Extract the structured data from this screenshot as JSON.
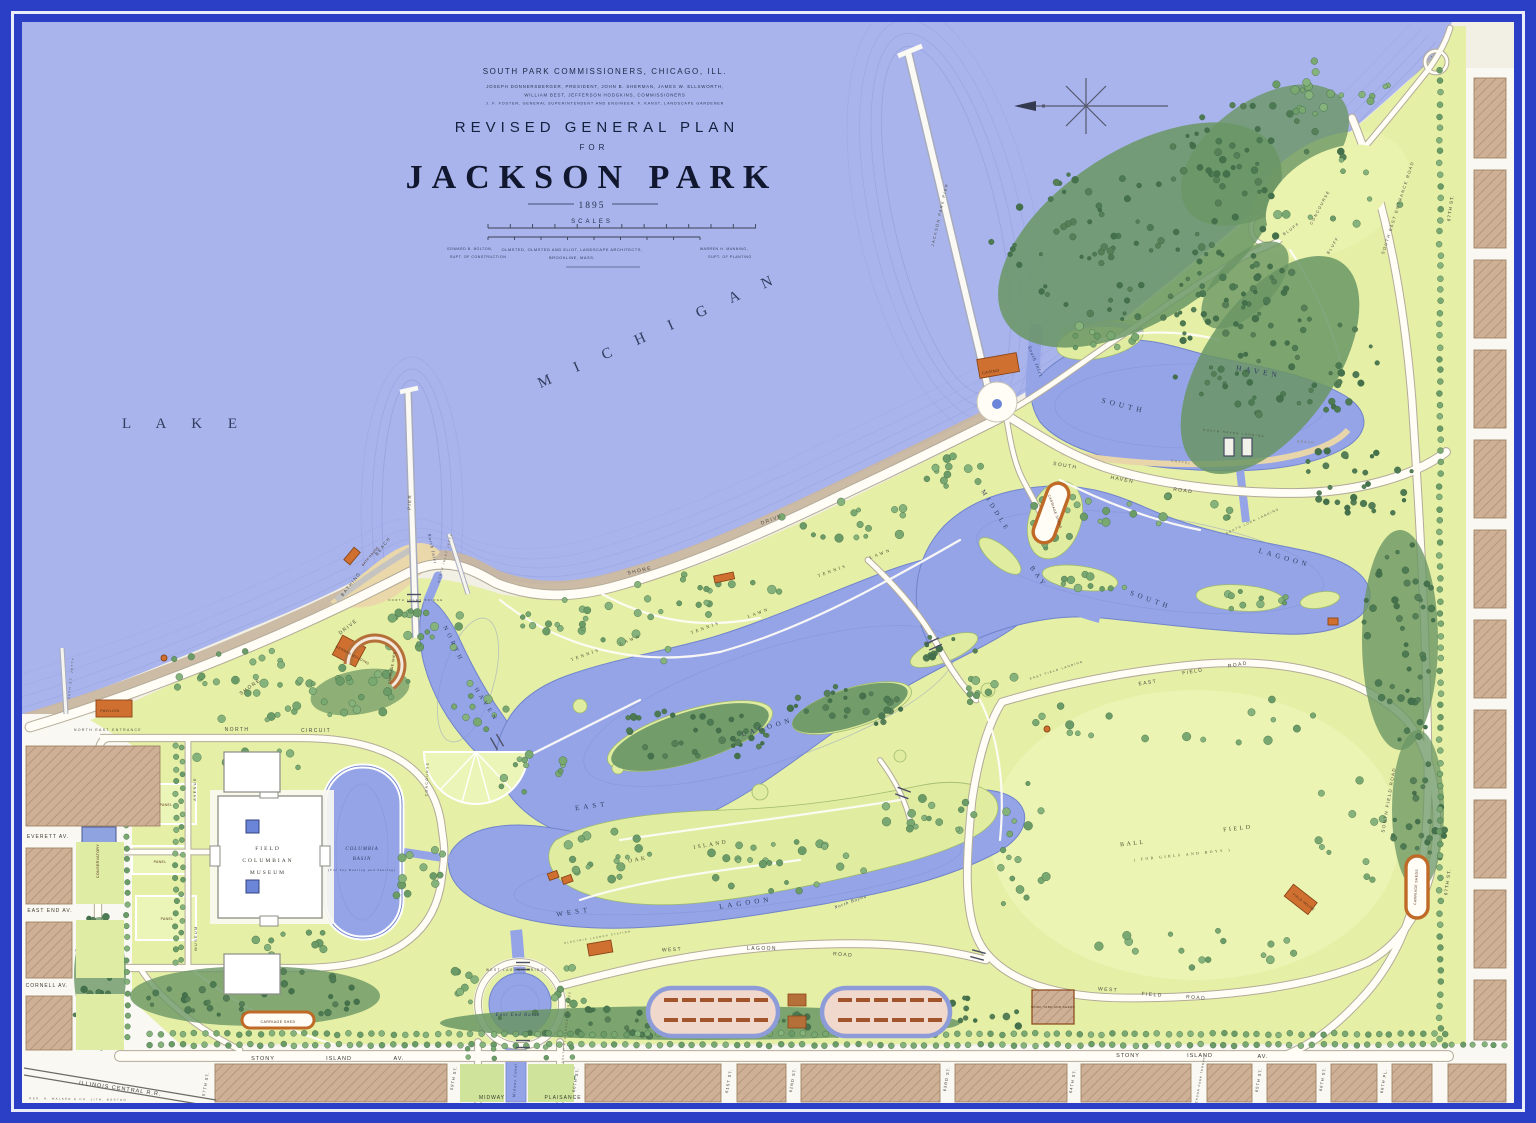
{
  "map": {
    "palette": {
      "frame_blue": "#2b3fc6",
      "frame_line": "#e9ecf9",
      "lake": "#a9b4ec",
      "lagoon": "#94a4e6",
      "park_green": "#e5efa5",
      "forest": "#6a9664",
      "city_block": "#cdb096",
      "gravel_shore": "#c9b7a1",
      "building_orange": "#cf7030",
      "road_white": "#fffdf6",
      "ink": "#27304f"
    },
    "title_block": {
      "org": "SOUTH PARK COMMISSIONERS, CHICAGO, ILL.",
      "line1": "JOSEPH DONNERSBERGER, PRESIDENT, JOHN B. SHERMAN, JAMES W. ELLSWORTH,",
      "line2": "WILLIAM BEST, JEFFERSON HODGKINS, COMMISSIONERS",
      "line3": "J. F. FOSTER, GENERAL SUPERINTENDENT AND ENGINEER, F. KANST, LANDSCAPE GARDENER",
      "title": "REVISED GENERAL PLAN",
      "for_word": "FOR",
      "park_name": "JACKSON PARK",
      "year": "1895",
      "scales": "SCALES",
      "credit_left1": "EDWARD B. BOLTON,",
      "credit_left2": "SUPT. OF CONSTRUCTION",
      "credit_center1": "OLMSTED, OLMSTED AND ELIOT, LANDSCAPE ARCHITECTS,",
      "credit_center2": "BROOKLINE,   MASS.",
      "credit_right1": "WARREN H. MANNING,",
      "credit_right2": "SUPT. OF PLANTING"
    },
    "labels": [
      {
        "t": "L A K E",
        "x": 185,
        "y": 428,
        "r": 0,
        "s": 15,
        "c": "big"
      },
      {
        "t": "M I C H I G A N",
        "x": 662,
        "y": 334,
        "r": -24,
        "s": 15,
        "c": "big"
      },
      {
        "t": "SOUTH",
        "x": 1123,
        "y": 408,
        "r": 14,
        "s": 7.5,
        "c": "wl"
      },
      {
        "t": "HAVEN",
        "x": 1258,
        "y": 374,
        "r": 10,
        "s": 7.5,
        "c": "wl"
      },
      {
        "t": "South Inlet",
        "x": 1034,
        "y": 362,
        "r": 68,
        "s": 5,
        "c": "wi"
      },
      {
        "t": "MIDDLE",
        "x": 994,
        "y": 512,
        "r": 58,
        "s": 6.5,
        "c": "wl"
      },
      {
        "t": "BAY",
        "x": 1037,
        "y": 578,
        "r": 55,
        "s": 6.5,
        "c": "wl"
      },
      {
        "t": "SOUTH",
        "x": 1150,
        "y": 602,
        "r": 20,
        "s": 7,
        "c": "wl"
      },
      {
        "t": "LAGOON",
        "x": 1284,
        "y": 560,
        "r": 16,
        "s": 7,
        "c": "wl"
      },
      {
        "t": "NORTH",
        "x": 452,
        "y": 645,
        "r": 64,
        "s": 6,
        "c": "wl"
      },
      {
        "t": "HAVEN",
        "x": 485,
        "y": 706,
        "r": 58,
        "s": 6,
        "c": "wl"
      },
      {
        "t": "North Inlet",
        "x": 431,
        "y": 549,
        "r": 78,
        "s": 4.5,
        "c": "wi"
      },
      {
        "t": "EAST",
        "x": 592,
        "y": 808,
        "r": -8,
        "s": 7,
        "c": "wl"
      },
      {
        "t": "LAGOON",
        "x": 768,
        "y": 729,
        "r": -16,
        "s": 7,
        "c": "wl"
      },
      {
        "t": "WEST",
        "x": 574,
        "y": 914,
        "r": -8,
        "s": 7,
        "c": "wl"
      },
      {
        "t": "LAGOON",
        "x": 746,
        "y": 905,
        "r": -8,
        "s": 7,
        "c": "wl"
      },
      {
        "t": "North Bayou",
        "x": 851,
        "y": 903,
        "r": -20,
        "s": 4.5,
        "c": "wi"
      },
      {
        "t": "OAK",
        "x": 638,
        "y": 861,
        "r": -10,
        "s": 5.5,
        "c": "al"
      },
      {
        "t": "ISLAND",
        "x": 711,
        "y": 846,
        "r": -10,
        "s": 5.5,
        "c": "al"
      },
      {
        "t": "TENNIS",
        "x": 586,
        "y": 656,
        "r": -20,
        "s": 4.5,
        "c": "al"
      },
      {
        "t": "LAWN",
        "x": 631,
        "y": 641,
        "r": -20,
        "s": 4.5,
        "c": "al"
      },
      {
        "t": "TENNIS",
        "x": 706,
        "y": 629,
        "r": -20,
        "s": 4.5,
        "c": "al"
      },
      {
        "t": "LAWN",
        "x": 759,
        "y": 614,
        "r": -20,
        "s": 4.5,
        "c": "al"
      },
      {
        "t": "TENNIS",
        "x": 833,
        "y": 572,
        "r": -20,
        "s": 4.5,
        "c": "al"
      },
      {
        "t": "LAWN",
        "x": 881,
        "y": 555,
        "r": -20,
        "s": 4.5,
        "c": "al"
      },
      {
        "t": "BALL",
        "x": 1133,
        "y": 845,
        "r": -6,
        "s": 6,
        "c": "al"
      },
      {
        "t": "FIELD",
        "x": 1238,
        "y": 830,
        "r": -6,
        "s": 6,
        "c": "al"
      },
      {
        "t": "( FOR GIRLS AND BOYS )",
        "x": 1183,
        "y": 856,
        "r": -6,
        "s": 3.8,
        "c": "al"
      },
      {
        "t": "FIELD",
        "x": 268,
        "y": 850,
        "r": 0,
        "s": 5.5,
        "c": "mus"
      },
      {
        "t": "COLUMBIAN",
        "x": 268,
        "y": 862,
        "r": 0,
        "s": 5.5,
        "c": "mus"
      },
      {
        "t": "MUSEUM",
        "x": 268,
        "y": 874,
        "r": 0,
        "s": 5.5,
        "c": "mus"
      },
      {
        "t": "COLUMBIA",
        "x": 362,
        "y": 850,
        "r": 0,
        "s": 5,
        "c": "wi"
      },
      {
        "t": "BASIN",
        "x": 362,
        "y": 860,
        "r": 0,
        "s": 5,
        "c": "wi"
      },
      {
        "t": "(For Toy Boating and Skating)",
        "x": 362,
        "y": 871,
        "r": 0,
        "s": 3.2,
        "c": "wi"
      },
      {
        "t": "East End Basin",
        "x": 518,
        "y": 1016,
        "r": 0,
        "s": 5,
        "c": "wi"
      },
      {
        "t": "Midway Canal",
        "x": 516,
        "y": 1080,
        "r": -87,
        "s": 3.8,
        "c": "wi"
      },
      {
        "t": "SHORE",
        "x": 251,
        "y": 688,
        "r": -36,
        "s": 5,
        "c": "rl"
      },
      {
        "t": "DRIVE",
        "x": 349,
        "y": 628,
        "r": -38,
        "s": 5,
        "c": "rl"
      },
      {
        "t": "SHORE",
        "x": 640,
        "y": 572,
        "r": -12,
        "s": 5,
        "c": "rl"
      },
      {
        "t": "DRIVE",
        "x": 772,
        "y": 521,
        "r": -20,
        "s": 5,
        "c": "rl"
      },
      {
        "t": "NORTH",
        "x": 237,
        "y": 731,
        "r": 0,
        "s": 5,
        "c": "rl"
      },
      {
        "t": "CIRCUIT",
        "x": 316,
        "y": 732,
        "r": 0,
        "s": 5,
        "c": "rl"
      },
      {
        "t": "SOUTH",
        "x": 1065,
        "y": 467,
        "r": 10,
        "s": 5,
        "c": "rl"
      },
      {
        "t": "HAVEN",
        "x": 1122,
        "y": 481,
        "r": 10,
        "s": 5,
        "c": "rl"
      },
      {
        "t": "ROAD",
        "x": 1183,
        "y": 492,
        "r": 8,
        "s": 5,
        "c": "rl"
      },
      {
        "t": "EAST",
        "x": 1148,
        "y": 684,
        "r": -9,
        "s": 5,
        "c": "rl"
      },
      {
        "t": "FIELD",
        "x": 1193,
        "y": 673,
        "r": -9,
        "s": 5,
        "c": "rl"
      },
      {
        "t": "ROAD",
        "x": 1238,
        "y": 666,
        "r": -9,
        "s": 5,
        "c": "rl"
      },
      {
        "t": "WEST",
        "x": 1108,
        "y": 991,
        "r": 4,
        "s": 5,
        "c": "rl"
      },
      {
        "t": "FIELD",
        "x": 1152,
        "y": 996,
        "r": 4,
        "s": 5,
        "c": "rl"
      },
      {
        "t": "ROAD",
        "x": 1196,
        "y": 999,
        "r": 4,
        "s": 5,
        "c": "rl"
      },
      {
        "t": "SOUTH FIELD ROAD",
        "x": 1390,
        "y": 800,
        "r": -80,
        "s": 4.5,
        "c": "rl"
      },
      {
        "t": "WEST",
        "x": 672,
        "y": 951,
        "r": -3,
        "s": 5,
        "c": "rl"
      },
      {
        "t": "LAGOON",
        "x": 762,
        "y": 950,
        "r": 0,
        "s": 5,
        "c": "rl"
      },
      {
        "t": "ROAD",
        "x": 843,
        "y": 956,
        "r": 4,
        "s": 5,
        "c": "rl"
      },
      {
        "t": "WEST LAGOON BRIDGE",
        "x": 517,
        "y": 971,
        "r": 0,
        "s": 3.2,
        "c": "rl"
      },
      {
        "t": "SOUTH EAST ENTRANCE ROAD",
        "x": 1399,
        "y": 208,
        "r": -72,
        "s": 4.2,
        "c": "rl"
      },
      {
        "t": "BLUFF",
        "x": 1292,
        "y": 230,
        "r": -35,
        "s": 4,
        "c": "rl"
      },
      {
        "t": "CONCOURSE",
        "x": 1321,
        "y": 208,
        "r": -62,
        "s": 4,
        "c": "rl"
      },
      {
        "t": "BLUFF",
        "x": 1334,
        "y": 246,
        "r": -58,
        "s": 4,
        "c": "rl"
      },
      {
        "t": "NORTH EAST ENTRANCE",
        "x": 108,
        "y": 731,
        "r": 0,
        "s": 3.4,
        "c": "rl"
      },
      {
        "t": "PAVILION",
        "x": 110,
        "y": 712,
        "r": 0,
        "s": 3.6,
        "c": "bl"
      },
      {
        "t": "CASINO",
        "x": 991,
        "y": 373,
        "r": -10,
        "s": 4,
        "c": "bl"
      },
      {
        "t": "GERMAN BUILDING",
        "x": 352,
        "y": 656,
        "r": 28,
        "s": 3.4,
        "c": "bl"
      },
      {
        "t": "BATH HOUSE",
        "x": 371,
        "y": 557,
        "r": -50,
        "s": 3.2,
        "c": "bl"
      },
      {
        "t": "BATHING",
        "x": 352,
        "y": 585,
        "r": -52,
        "s": 4.5,
        "c": "rl"
      },
      {
        "t": "BEACH",
        "x": 384,
        "y": 547,
        "r": -52,
        "s": 4.5,
        "c": "rl"
      },
      {
        "t": "CARRIAGE SHED",
        "x": 393,
        "y": 668,
        "r": -80,
        "s": 3.4,
        "c": "bl"
      },
      {
        "t": "CARRIAGE SHEDS",
        "x": 1054,
        "y": 512,
        "r": 70,
        "s": 3.4,
        "c": "bl"
      },
      {
        "t": "CARRIAGE SHEDS",
        "x": 1417,
        "y": 887,
        "r": -87,
        "s": 3.4,
        "c": "bl"
      },
      {
        "t": "CARRIAGE SHED",
        "x": 278,
        "y": 1023,
        "r": 0,
        "s": 3.6,
        "c": "bl"
      },
      {
        "t": "FIELD HOUSE",
        "x": 1303,
        "y": 903,
        "r": 38,
        "s": 3.4,
        "c": "bl"
      },
      {
        "t": "WORK YARD AND SHEDS",
        "x": 1053,
        "y": 1008,
        "r": 0,
        "s": 3,
        "c": "bl"
      },
      {
        "t": "ELECTRIC LAUNCH STATION",
        "x": 598,
        "y": 938,
        "r": -10,
        "s": 2.6,
        "c": "rl"
      },
      {
        "t": "PIER",
        "x": 411,
        "y": 502,
        "r": -88,
        "s": 4.5,
        "c": "rl"
      },
      {
        "t": "JACKSON PARK PIER",
        "x": 941,
        "y": 215,
        "r": -77,
        "s": 4,
        "c": "rl"
      },
      {
        "t": "PANEL",
        "x": 166,
        "y": 806,
        "r": 0,
        "s": 3.4,
        "c": "bl"
      },
      {
        "t": "PANEL",
        "x": 160,
        "y": 863,
        "r": 0,
        "s": 3.4,
        "c": "bl"
      },
      {
        "t": "PANEL",
        "x": 167,
        "y": 920,
        "r": 0,
        "s": 3.4,
        "c": "bl"
      },
      {
        "t": "AVENUE",
        "x": 196,
        "y": 789,
        "r": -90,
        "s": 3.8,
        "c": "rl"
      },
      {
        "t": "MUSEUM",
        "x": 197,
        "y": 938,
        "r": -90,
        "s": 3.8,
        "c": "rl"
      },
      {
        "t": "CONSERVATORY",
        "x": 99,
        "y": 861,
        "r": -90,
        "s": 3.6,
        "c": "bl"
      },
      {
        "t": "CONCOURSE",
        "x": 428,
        "y": 779,
        "r": -88,
        "s": 3.4,
        "c": "rl"
      },
      {
        "t": "EVERETT AV.",
        "x": 48,
        "y": 838,
        "r": 0,
        "s": 5,
        "c": "st"
      },
      {
        "t": "EAST END AV.",
        "x": 50,
        "y": 912,
        "r": 0,
        "s": 5,
        "c": "st"
      },
      {
        "t": "CORNELL AV.",
        "x": 47,
        "y": 987,
        "r": 0,
        "s": 5,
        "c": "st"
      },
      {
        "t": "STONY",
        "x": 263,
        "y": 1060,
        "r": 0,
        "s": 5.5,
        "c": "st"
      },
      {
        "t": "ISLAND",
        "x": 339,
        "y": 1060,
        "r": 0,
        "s": 5.5,
        "c": "st"
      },
      {
        "t": "AV.",
        "x": 399,
        "y": 1060,
        "r": 0,
        "s": 5.5,
        "c": "st"
      },
      {
        "t": "STONY",
        "x": 1128,
        "y": 1057,
        "r": 0,
        "s": 5.5,
        "c": "st"
      },
      {
        "t": "ISLAND",
        "x": 1200,
        "y": 1057,
        "r": 0,
        "s": 5.5,
        "c": "st"
      },
      {
        "t": "AV.",
        "x": 1263,
        "y": 1058,
        "r": 0,
        "s": 5.5,
        "c": "st"
      },
      {
        "t": "ILLINOIS  CENTRAL  R.R.",
        "x": 120,
        "y": 1090,
        "r": 8,
        "s": 5.5,
        "c": "st"
      },
      {
        "t": "GEO. H. WALKER & CO. LITH. BOSTON",
        "x": 78,
        "y": 1100,
        "r": 1,
        "s": 2.8,
        "c": "rl"
      },
      {
        "t": "MIDWAY",
        "x": 492,
        "y": 1099,
        "r": 0,
        "s": 5,
        "c": "st"
      },
      {
        "t": "PLAISANCE",
        "x": 563,
        "y": 1099,
        "r": 0,
        "s": 5,
        "c": "st"
      },
      {
        "t": "57TH ST.",
        "x": 207,
        "y": 1084,
        "r": -80,
        "s": 4,
        "c": "st"
      },
      {
        "t": "59TH ST.",
        "x": 455,
        "y": 1078,
        "r": -80,
        "s": 4,
        "c": "st"
      },
      {
        "t": "60TH ST.",
        "x": 577,
        "y": 1080,
        "r": -80,
        "s": 4,
        "c": "st"
      },
      {
        "t": "61ST ST.",
        "x": 730,
        "y": 1081,
        "r": -80,
        "s": 4,
        "c": "st"
      },
      {
        "t": "62ND ST.",
        "x": 794,
        "y": 1080,
        "r": -80,
        "s": 4,
        "c": "st"
      },
      {
        "t": "63RD ST.",
        "x": 948,
        "y": 1079,
        "r": -80,
        "s": 4,
        "c": "st"
      },
      {
        "t": "64TH ST.",
        "x": 1074,
        "y": 1081,
        "r": -80,
        "s": 4,
        "c": "st"
      },
      {
        "t": "JACKSON PARK TERRACE",
        "x": 1201,
        "y": 1081,
        "r": -80,
        "s": 2.8,
        "c": "st"
      },
      {
        "t": "65TH ST.",
        "x": 1260,
        "y": 1080,
        "r": -80,
        "s": 4,
        "c": "st"
      },
      {
        "t": "66TH ST.",
        "x": 1324,
        "y": 1079,
        "r": -80,
        "s": 4,
        "c": "st"
      },
      {
        "t": "66TH PL.",
        "x": 1385,
        "y": 1081,
        "r": -80,
        "s": 4,
        "c": "st"
      },
      {
        "t": "67TH ST.",
        "x": 1452,
        "y": 208,
        "r": -82,
        "s": 4.5,
        "c": "st"
      },
      {
        "t": "67TH ST.",
        "x": 1449,
        "y": 882,
        "r": -82,
        "s": 4.5,
        "c": "st"
      },
      {
        "t": "56TH ST. JETTY",
        "x": 72,
        "y": 678,
        "r": -84,
        "s": 3,
        "c": "rl"
      },
      {
        "t": "NORTH INLET JETTY",
        "x": 446,
        "y": 558,
        "r": -75,
        "s": 2.8,
        "c": "rl"
      },
      {
        "t": "NORTH INLET BRIDGE",
        "x": 416,
        "y": 601,
        "r": 0,
        "s": 2.8,
        "c": "rl"
      },
      {
        "t": "SOUTH HAVEN LANDING",
        "x": 1234,
        "y": 434,
        "r": 6,
        "s": 3,
        "c": "rl"
      },
      {
        "t": "SOUTH LOCK LANDING",
        "x": 1253,
        "y": 522,
        "r": -25,
        "s": 3,
        "c": "rl"
      },
      {
        "t": "EAST FIELD LANDING",
        "x": 1057,
        "y": 671,
        "r": -18,
        "s": 3,
        "c": "rl"
      },
      {
        "t": "GRAVEL",
        "x": 1181,
        "y": 463,
        "r": 8,
        "s": 3.4,
        "c": "rl2"
      },
      {
        "t": "BEACH",
        "x": 1306,
        "y": 443,
        "r": 4,
        "s": 3.4,
        "c": "rl2"
      },
      {
        "t": "SOUTH PLAISANCE ENTRANCE",
        "x": 567,
        "y": 1027,
        "r": -84,
        "s": 2.6,
        "c": "rl"
      }
    ]
  }
}
